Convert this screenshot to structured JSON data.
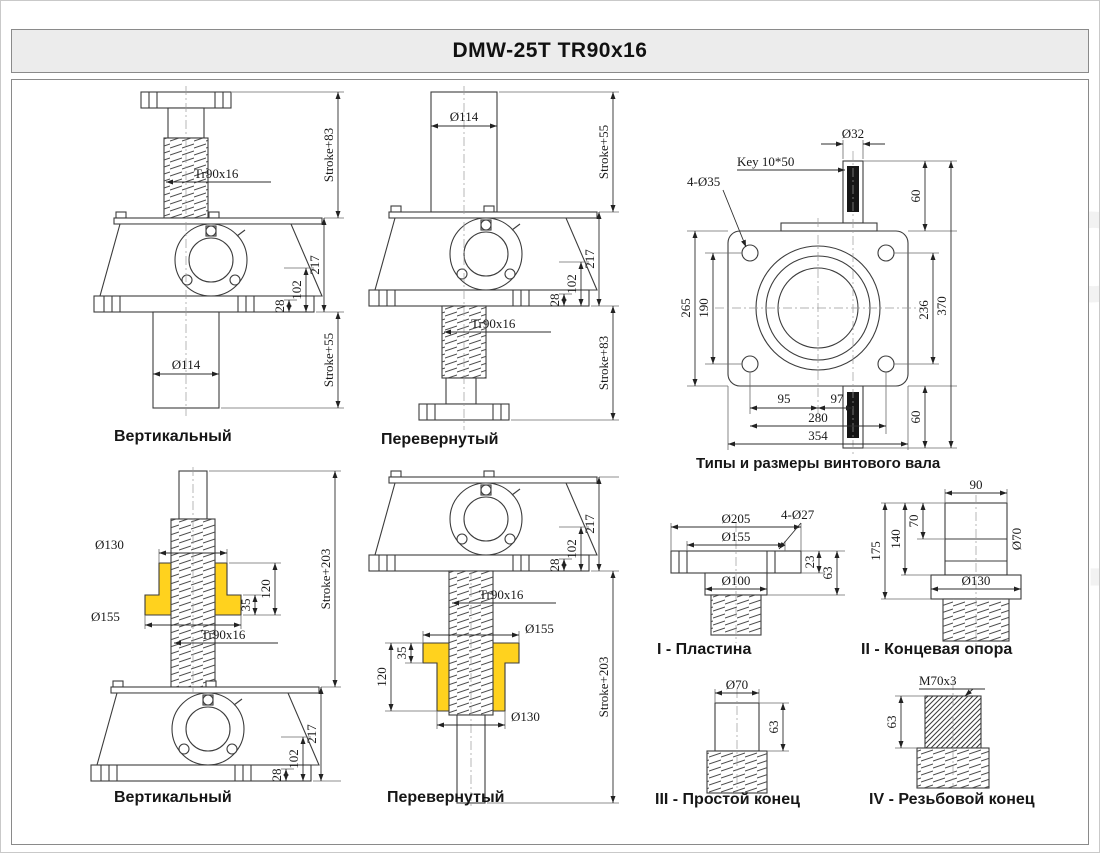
{
  "title": "DMW-25T TR90x16",
  "watermark": {
    "ton": "ТОН",
    "ast": "АСТ"
  },
  "colors": {
    "nut_highlight": "#FFD21E",
    "title_bg": "#ECECEC",
    "line": "#3C3C3C"
  },
  "labels": {
    "vertical_top": "Вертикальный",
    "inverted_top": "Перевернутый",
    "vertical_bottom": "Вертикальный",
    "inverted_bottom": "Перевернутый",
    "shaft_types_heading": "Типы и размеры винтового вала",
    "type1": "I - Пластина",
    "type2": "II - Концевая опора",
    "type3": "III - Простой конец",
    "type4": "IV - Резьбовой конец"
  },
  "top_left": {
    "screw": "Tr90x16",
    "stroke_top": "Stroke+83",
    "h217": "217",
    "h102": "102",
    "h28": "28",
    "stroke_bottom": "Stroke+55",
    "d114": "Ø114"
  },
  "top_mid": {
    "d114": "Ø114",
    "stroke_top": "Stroke+55",
    "h217": "217",
    "h102": "102",
    "h28": "28",
    "screw": "Tr90x16",
    "stroke_bottom": "Stroke+83"
  },
  "top_view": {
    "d32": "Ø32",
    "key": "Key 10*50",
    "holes": "4-Ø35",
    "h60_top": "60",
    "v265": "265",
    "v190": "190",
    "v236": "236",
    "v370": "370",
    "h60_bottom": "60",
    "b95": "95",
    "b97": "97",
    "b280": "280",
    "b354": "354"
  },
  "bottom_left": {
    "d130": "Ø130",
    "d155": "Ø155",
    "h120": "120",
    "h35": "35",
    "screw": "Tr90x16",
    "stroke": "Stroke+203",
    "h217": "217",
    "h102": "102",
    "h28": "28"
  },
  "bottom_mid": {
    "h217": "217",
    "h102": "102",
    "h28": "28",
    "screw": "Tr90x16",
    "d155": "Ø155",
    "h35": "35",
    "h120": "120",
    "d130": "Ø130",
    "stroke": "Stroke+203"
  },
  "type1": {
    "d205": "Ø205",
    "d155": "Ø155",
    "holes": "4-Ø27",
    "d100": "Ø100",
    "t23": "23",
    "h63": "63"
  },
  "type2": {
    "w90": "90",
    "h70": "70",
    "h140": "140",
    "h175": "175",
    "d70": "Ø70",
    "d130": "Ø130"
  },
  "type3": {
    "d70": "Ø70",
    "h63": "63"
  },
  "type4": {
    "thread": "M70x3",
    "h63": "63"
  }
}
